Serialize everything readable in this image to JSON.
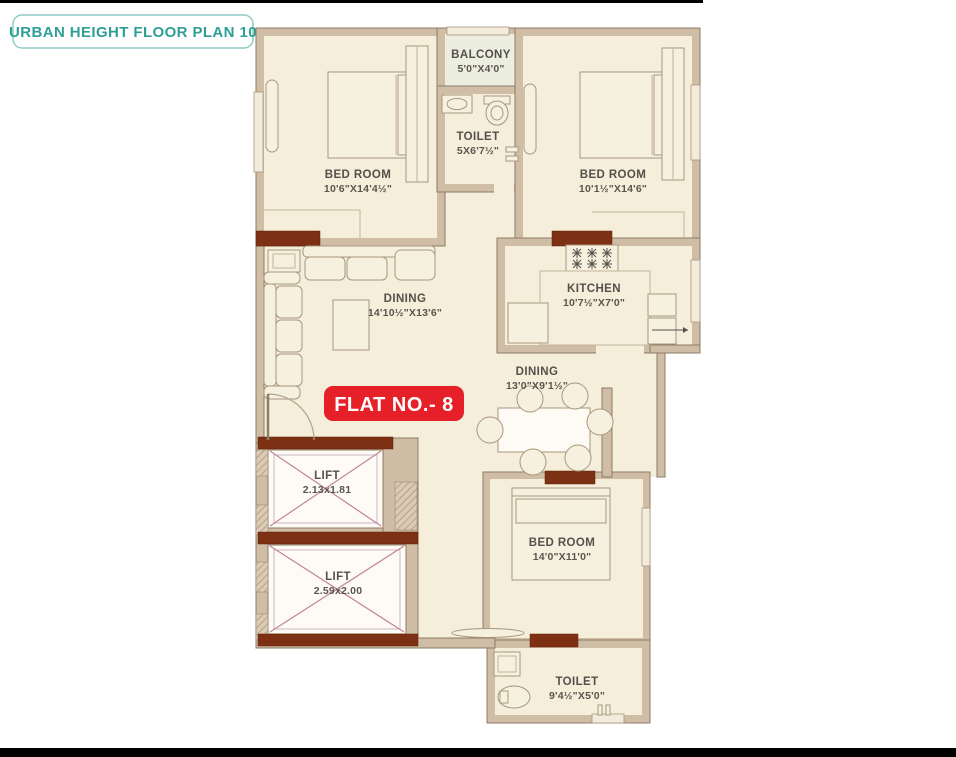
{
  "title": "URBAN HEIGHT FLOOR PLAN 10",
  "flat_badge": "FLAT NO.- 8",
  "colors": {
    "teal": "#2f9f96",
    "red": "#e52028",
    "wall": "#cfbda6",
    "floor": "#f4eeda",
    "lintel_brown": "#7d3013",
    "lift_cross_pink": "#c2849c",
    "label_text": "#55504b"
  },
  "rooms": {
    "balcony": {
      "name": "BALCONY",
      "size": "5'0\"X4'0\""
    },
    "toilet_top": {
      "name": "TOILET",
      "size": "5X6'7½\""
    },
    "bedroom_top_left": {
      "name": "BED ROOM",
      "size": "10'6\"X14'4½\""
    },
    "bedroom_top_right": {
      "name": "BED ROOM",
      "size": "10'1½\"X14'6\""
    },
    "living_dining": {
      "name": "DINING",
      "size": "14'10½\"X13'6\""
    },
    "kitchen": {
      "name": "KITCHEN",
      "size": "10'7½\"X7'0\""
    },
    "dining": {
      "name": "DINING",
      "size": "13'0\"X9'1½\""
    },
    "lift_upper": {
      "name": "LIFT",
      "size": "2.13x1.81"
    },
    "lift_lower": {
      "name": "LIFT",
      "size": "2.59x2.00"
    },
    "bedroom_bottom": {
      "name": "BED ROOM",
      "size": "14'0\"X11'0\""
    },
    "toilet_bottom": {
      "name": "TOILET",
      "size": "9'4½\"X5'0\""
    }
  }
}
